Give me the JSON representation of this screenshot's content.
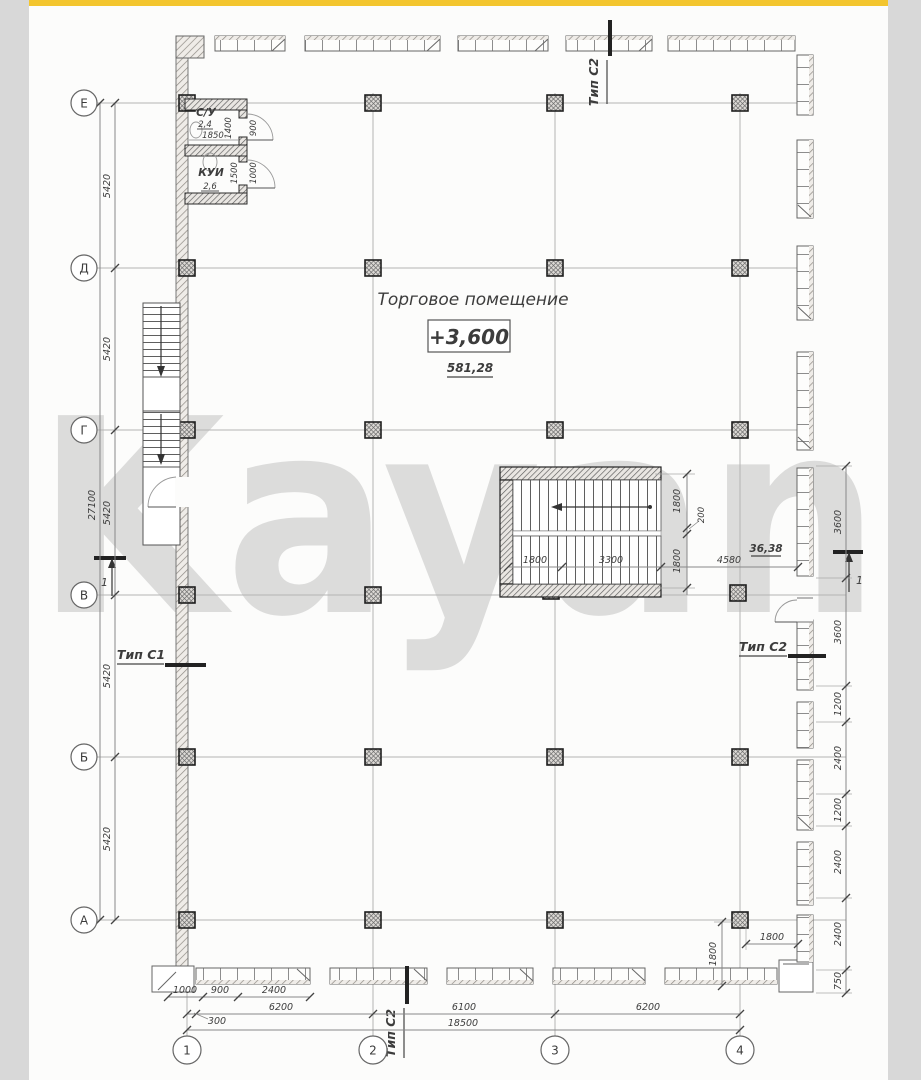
{
  "window": {
    "top_bar_color": "#f3c52e",
    "paper_color": "#fcfcfb",
    "margin_color": "#d8d8d8"
  },
  "watermark": {
    "text": "Kayan",
    "color": "#e05476"
  },
  "plan": {
    "hall": {
      "name": "Торговое помещение",
      "level": "+3,600",
      "area": "581,28"
    },
    "stairwell_area": "36,38",
    "axes": {
      "rows": [
        "Е",
        "Д",
        "Г",
        "В",
        "Б",
        "А"
      ],
      "cols": [
        "1",
        "2",
        "3",
        "4"
      ]
    },
    "rooms": {
      "wc": {
        "name": "С/У",
        "area": "2,4",
        "width": "1850",
        "depth": "1400",
        "door": "900"
      },
      "kui": {
        "name": "КУИ",
        "area": "2,6",
        "depth": "1500",
        "door": "1000"
      }
    },
    "markers": {
      "type_c1": "Тип С1",
      "type_c2": "Тип С2",
      "section": "1"
    },
    "dims": {
      "left": {
        "overall": "27100",
        "segments": [
          "5420",
          "5420",
          "5420",
          "5420",
          "5420"
        ]
      },
      "right": [
        "3600",
        "3600",
        "1200",
        "2400",
        "1200",
        "2400",
        "2400",
        "750"
      ],
      "bottom": {
        "row1": [
          "1000",
          "900",
          "2400"
        ],
        "offset": "300",
        "row2": [
          "6200",
          "6100",
          "6200"
        ],
        "overall": "18500"
      },
      "stair": {
        "left": "1800",
        "mid": "3300",
        "right": "4580",
        "top": "1800",
        "small": "200",
        "bottom": "1800"
      },
      "corner4": {
        "vertical": "1800",
        "horizontal": "1800"
      }
    }
  }
}
